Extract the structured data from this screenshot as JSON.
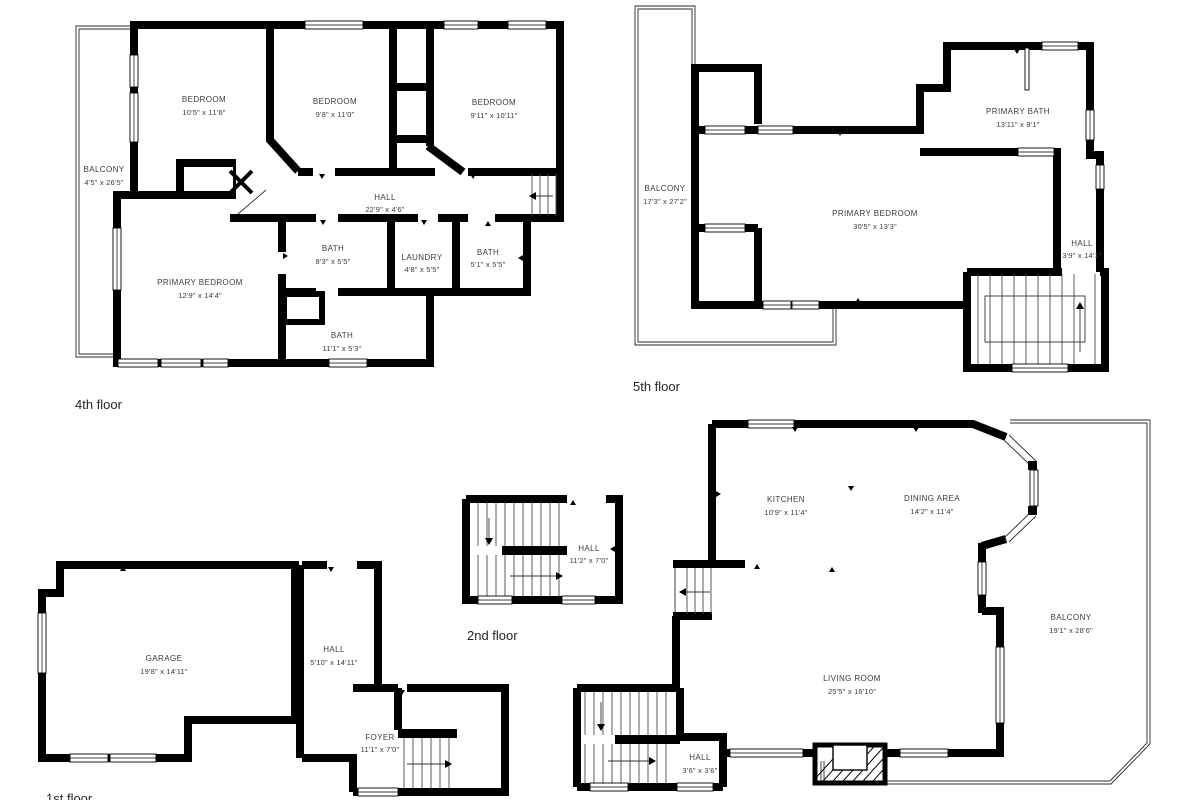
{
  "colors": {
    "wall": "#000000",
    "room_text": "#3c3c3c",
    "floor_label_text": "#262626",
    "background": "#ffffff"
  },
  "floors": {
    "f4": {
      "label": "4th floor",
      "rooms": {
        "bedroom1": {
          "name": "BEDROOM",
          "dims": "10'5\" x 11'6\""
        },
        "bedroom2": {
          "name": "BEDROOM",
          "dims": "9'8\" x 11'0\""
        },
        "bedroom3": {
          "name": "BEDROOM",
          "dims": "9'11\" x 10'11\""
        },
        "balcony": {
          "name": "BALCONY",
          "dims": "4'5\" x 26'5\""
        },
        "hall": {
          "name": "HALL",
          "dims": "22'9\" x 4'6\""
        },
        "bath1": {
          "name": "BATH",
          "dims": "8'3\" x 5'5\""
        },
        "laundry": {
          "name": "LAUNDRY",
          "dims": "4'8\" x 5'5\""
        },
        "bath2": {
          "name": "BATH",
          "dims": "5'1\" x 5'5\""
        },
        "primary_bedroom": {
          "name": "PRIMARY BEDROOM",
          "dims": "12'9\" x 14'4\""
        },
        "bath3": {
          "name": "BATH",
          "dims": "11'1\" x 5'3\""
        }
      }
    },
    "f5": {
      "label": "5th floor",
      "rooms": {
        "balcony": {
          "name": "BALCONY",
          "dims": "17'3\" x 27'2\""
        },
        "primary_bedroom": {
          "name": "PRIMARY BEDROOM",
          "dims": "30'5\" x 13'3\""
        },
        "primary_bath": {
          "name": "PRIMARY BATH",
          "dims": "13'11\" x 8'1\""
        },
        "hall": {
          "name": "HALL",
          "dims": "3'9\" x 14'1\""
        }
      }
    },
    "f2": {
      "label": "2nd floor",
      "rooms": {
        "hall": {
          "name": "HALL",
          "dims": "11'2\" x 7'0\""
        }
      }
    },
    "f1": {
      "label": "1st floor",
      "rooms": {
        "garage": {
          "name": "GARAGE",
          "dims": "19'8\" x 14'11\""
        },
        "hall": {
          "name": "HALL",
          "dims": "5'10\" x 14'11\""
        },
        "foyer": {
          "name": "FOYER",
          "dims": "11'1\" x 7'0\""
        }
      }
    },
    "f3": {
      "rooms": {
        "kitchen": {
          "name": "KITCHEN",
          "dims": "10'9\" x 11'4\""
        },
        "dining": {
          "name": "DINING AREA",
          "dims": "14'2\" x 11'4\""
        },
        "balcony": {
          "name": "BALCONY",
          "dims": "19'1\" x 28'6\""
        },
        "living": {
          "name": "LIVING ROOM",
          "dims": "25'5\" x 16'10\""
        },
        "hall": {
          "name": "HALL",
          "dims": "3'6\" x 3'6\""
        }
      }
    }
  }
}
